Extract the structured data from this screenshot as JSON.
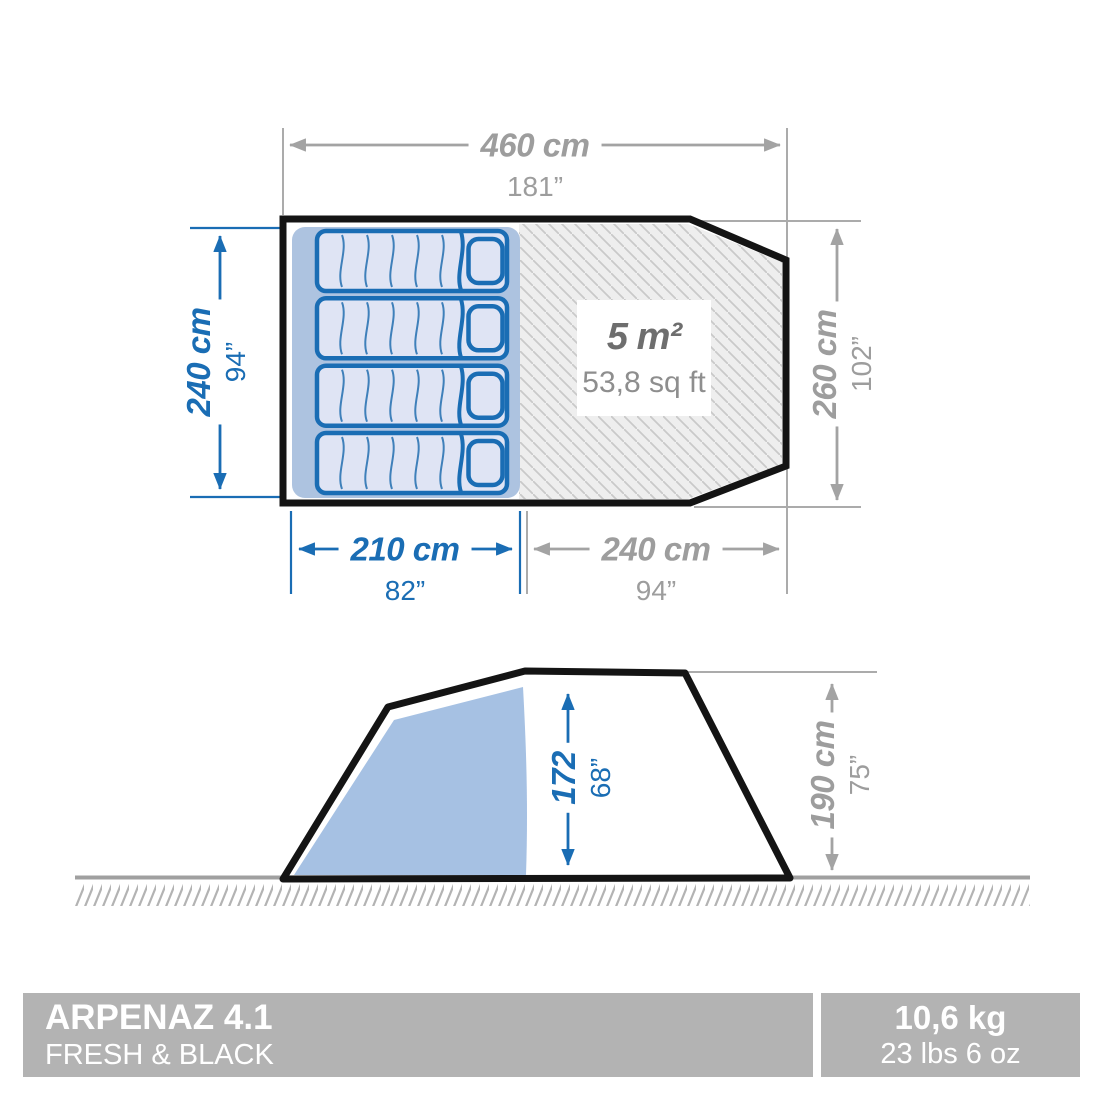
{
  "top_view": {
    "total_width": {
      "cm": "460 cm",
      "in": "181”"
    },
    "bedroom_depth": {
      "cm": "240 cm",
      "in": "94”"
    },
    "total_depth": {
      "cm": "260 cm",
      "in": "102”"
    },
    "bedroom_width": {
      "cm": "210 cm",
      "in": "82”"
    },
    "living_room_width": {
      "cm": "240 cm",
      "in": "94”"
    },
    "living_room_area": {
      "m2": "5 m²",
      "sqft": "53,8 sq ft"
    }
  },
  "side_view": {
    "interior_height": {
      "cm": "172",
      "in": "68”"
    },
    "exterior_height": {
      "cm": "190 cm",
      "in": "75”"
    }
  },
  "footer": {
    "model": "ARPENAZ 4.1",
    "line": "FRESH & BLACK",
    "weight": {
      "kg": "10,6 kg",
      "imperial": "23 lbs 6 oz"
    }
  },
  "colors": {
    "dimension_blue": "#1a6db4",
    "dimension_gray": "#9d9d9d",
    "tent_outline": "#141414",
    "sleeping_area_blue": "#adc3e0",
    "pad_fill": "#dfe4f4",
    "side_shade_blue": "#a6c1e3",
    "hatch_background": "#eeeeee",
    "badge_gray": "#b3b3b3"
  }
}
